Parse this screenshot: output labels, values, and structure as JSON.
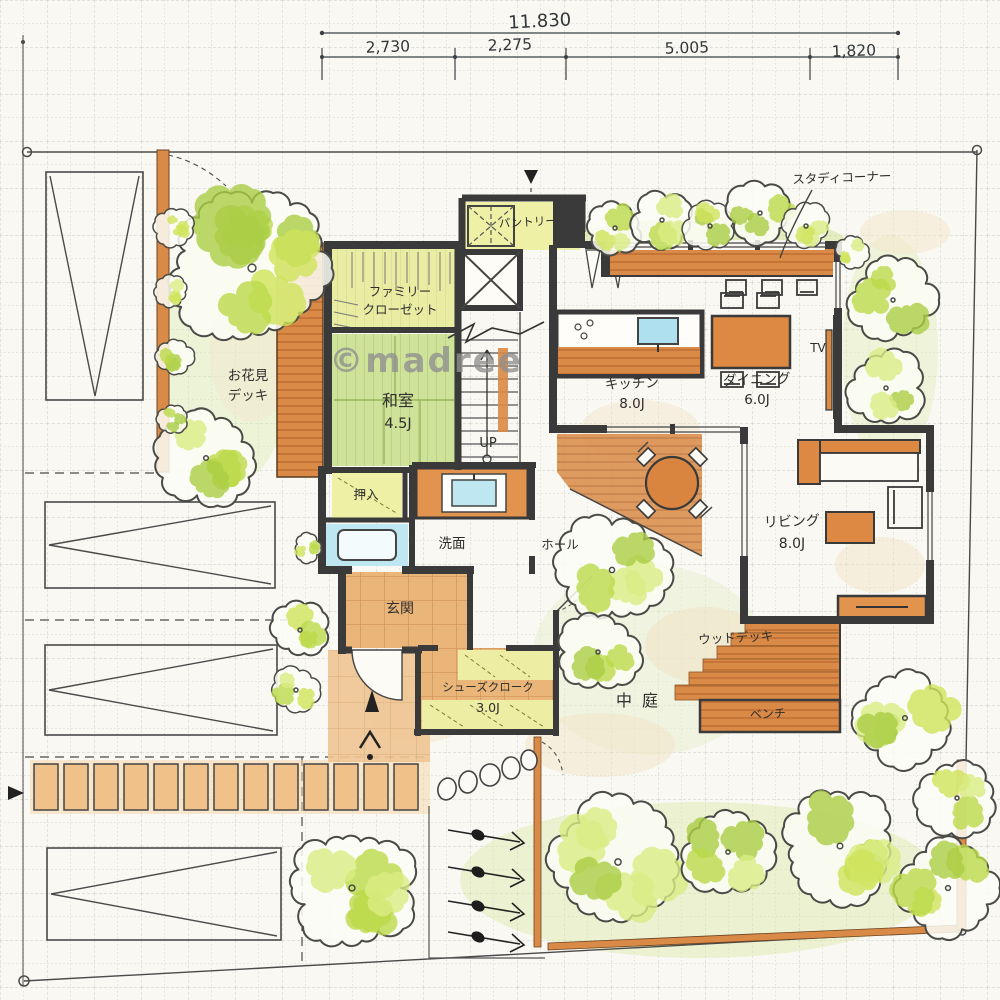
{
  "watermark": "©madree",
  "dimensions": {
    "total": "11.830",
    "segments": [
      "2,730",
      "2,275",
      "5.005",
      "1,820"
    ]
  },
  "labels": {
    "study_corner": "スタディコーナー",
    "pantry": "パントリー",
    "family_closet_1": "ファミリー",
    "family_closet_2": "クローゼット",
    "hanami_deck_1": "お花見",
    "hanami_deck_2": "デッキ",
    "washitsu": "和室",
    "washitsu_size": "4.5J",
    "up": "UP",
    "oshiire": "押入",
    "senmen": "洗面",
    "hall": "ホール",
    "genkan": "玄関",
    "shoes_1": "シューズクローク",
    "shoes_2": "3.0J",
    "kitchen": "キッチン",
    "kitchen_size": "8.0J",
    "dining": "ダイニング",
    "dining_size": "6.0J",
    "tv": "TV",
    "living": "リビング",
    "living_size": "8.0J",
    "wood_deck": "ウッドデッキ",
    "bench": "ベンチ",
    "courtyard": "中庭"
  },
  "colors": {
    "wall": "#3a3a3a",
    "wood": "#d98a46",
    "wood_light": "#f0c189",
    "tatami_green": "#cfe29a",
    "closet_yellow": "#edf0a5",
    "water_blue": "#bfe7f1",
    "tree_green": "#c3df52",
    "paper": "#f9f8f2"
  }
}
